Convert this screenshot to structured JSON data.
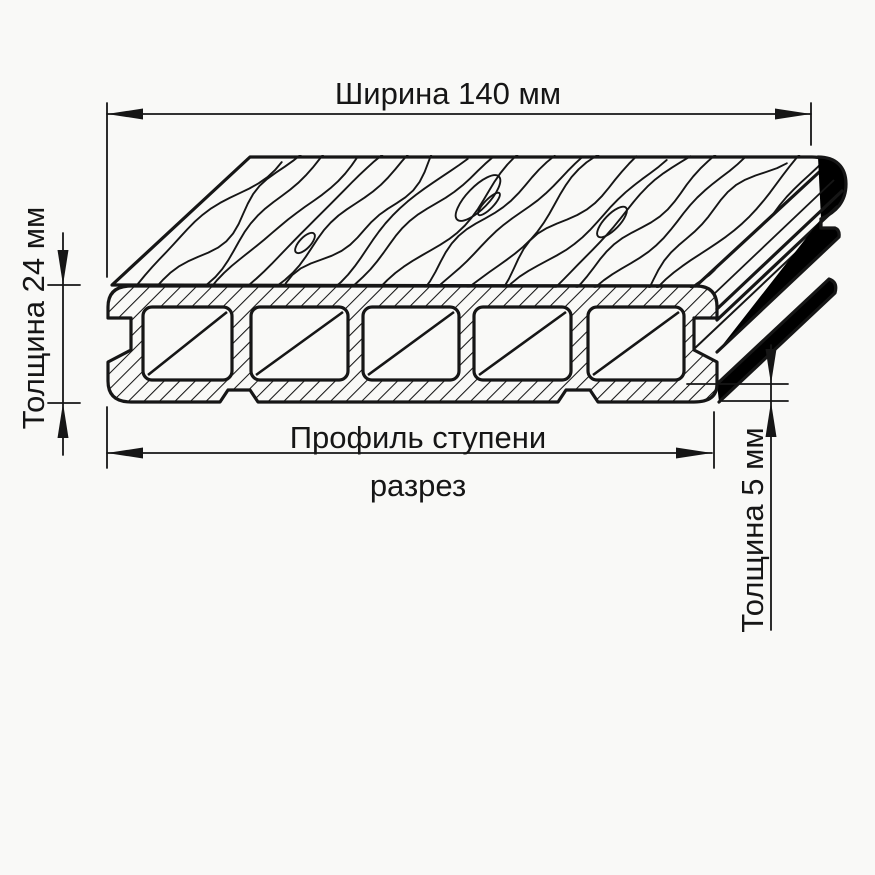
{
  "colors": {
    "background": "#f9f9f7",
    "ink": "#161616"
  },
  "drawing": {
    "width_dimension": "Ширина 140 мм",
    "thickness_dimension": "Толщина 24 мм",
    "caption_line1": "Профиль ступени",
    "caption_line2": "разрез",
    "wall_thickness_dimension": "Толщина 5 мм",
    "width_mm": 140,
    "thickness_mm": 24,
    "wall_thickness_mm": 5,
    "hollow_chambers": 5
  }
}
